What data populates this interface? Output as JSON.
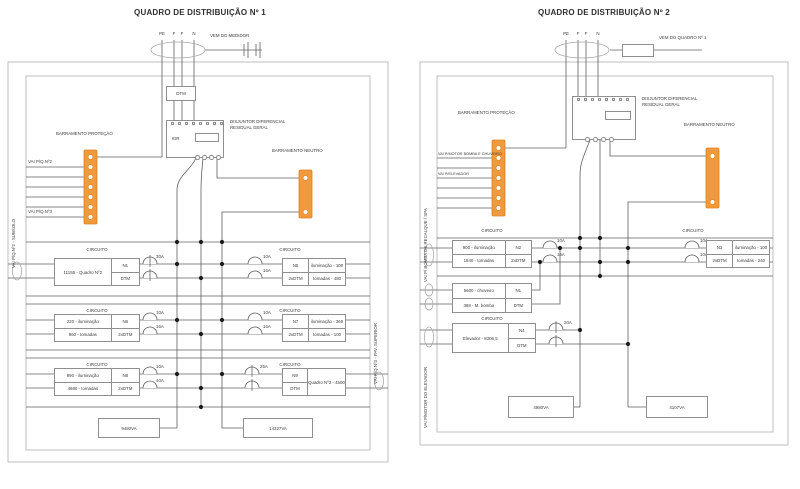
{
  "colors": {
    "busbar_fill": "#F09A3F",
    "busbar_stroke": "#DD7F1F",
    "wire": "#5f5f5f",
    "frame": "#b8b8b8",
    "dot": "#1c1c1c"
  },
  "panel1": {
    "title": "QUADRO DE DISTRIBUIÇÃO Nº 1",
    "conductors": [
      "PE",
      "F",
      "F",
      "N"
    ],
    "source_label": "VEM DO MEDIDOR",
    "dtm_label": "DTM",
    "main_breaker_id": "IDR",
    "main_breaker_label": "DISJUNTOR DIFERENCIAL RESIDUAL GERAL",
    "protection_bus_label": "BARRAMENTO PROTEÇÃO",
    "neutral_bus_label": "BARRAMENTO NEUTRO",
    "tap_label_top": "VAI P/Q.Nº2",
    "tap_label_bottom": "VAI P/Q.Nº3",
    "edge_label_left": "VAI P/Q.Nº2 - SUBSOLO",
    "edge_label_right": "VAI P/Q.Nº3 - PAV. SUPERIOR",
    "circuito": "CIRCUITO",
    "rows": [
      {
        "left": {
          "load1": "11155 - Quadro Nº2",
          "id": "N1",
          "prot": "DTM",
          "amp1": "30A"
        },
        "right": {
          "id": "N5",
          "prot": "2xDTM",
          "load1": "iluminação - 100",
          "load2": "tomadas - 480",
          "amp1": "10A",
          "amp2": "16A"
        }
      },
      {
        "left": {
          "load1": "220 - iluminação",
          "load2": "960 - tomadas",
          "id": "N6",
          "prot": "2xDTM",
          "amp1": "10A",
          "amp2": "16A"
        },
        "right": {
          "id": "N7",
          "prot": "2xDTM",
          "load1": "iluminação - 360",
          "load2": "tomadas - 100",
          "amp1": "10A",
          "amp2": "16A"
        }
      },
      {
        "left": {
          "load1": "990 - iluminação",
          "load2": "4980 - tomadas",
          "id": "N8",
          "prot": "2xDTM",
          "amp1": "10A",
          "amp2": "40A"
        },
        "right": {
          "id": "N9",
          "prot": "DTM",
          "load1": "Quadro Nº3 - 4500",
          "amp1": "25A"
        }
      }
    ],
    "total_left": "9480VA",
    "total_right": "14327VA"
  },
  "panel2": {
    "title": "QUADRO DE DISTRIBUIÇÃO Nº 2",
    "conductors": [
      "PE",
      "F",
      "F",
      "N"
    ],
    "source_label": "VEM DO QUADRO Nº 1",
    "main_breaker_label": "DISJUNTOR DIFERENCIAL RESIDUAL GERAL",
    "protection_bus_label": "BARRAMENTO PROTEÇÃO",
    "neutral_bus_label": "BARRAMENTO NEUTRO",
    "tap_label_top": "VAI P/MOTOR BOMBA E CHUVEIRO",
    "tap_label_bottom": "VAI P/ELEVADOR",
    "edge_label_top": "VAI P/ BOMBA DE RECALQUE / SPA",
    "edge_label_bottom": "VAI P/MOTOR DO ELEVADOR",
    "circuito": "CIRCUITO",
    "rows": [
      {
        "left": {
          "load1": "900 - iluminação",
          "load2": "1840 - tomadas",
          "id": "N2",
          "prot": "2xDTM",
          "amp1": "10A",
          "amp2": "16A"
        },
        "right": {
          "id": "N3",
          "prot": "2xDTM",
          "load1": "iluminação - 100",
          "load2": "tomadas - 240",
          "amp1": "10A",
          "amp2": "10A"
        }
      },
      {
        "left": {
          "load1": "5600 - chuveiro",
          "load2": "368 - M. bomba",
          "id": "N1",
          "prot": "DTM"
        }
      },
      {
        "left": {
          "load1": "Elevador - 8306,5",
          "id": "N4",
          "prot": "DTM",
          "amp1": "20A"
        }
      }
    ],
    "total_left": "4980VA",
    "total_right": "4107VA"
  }
}
